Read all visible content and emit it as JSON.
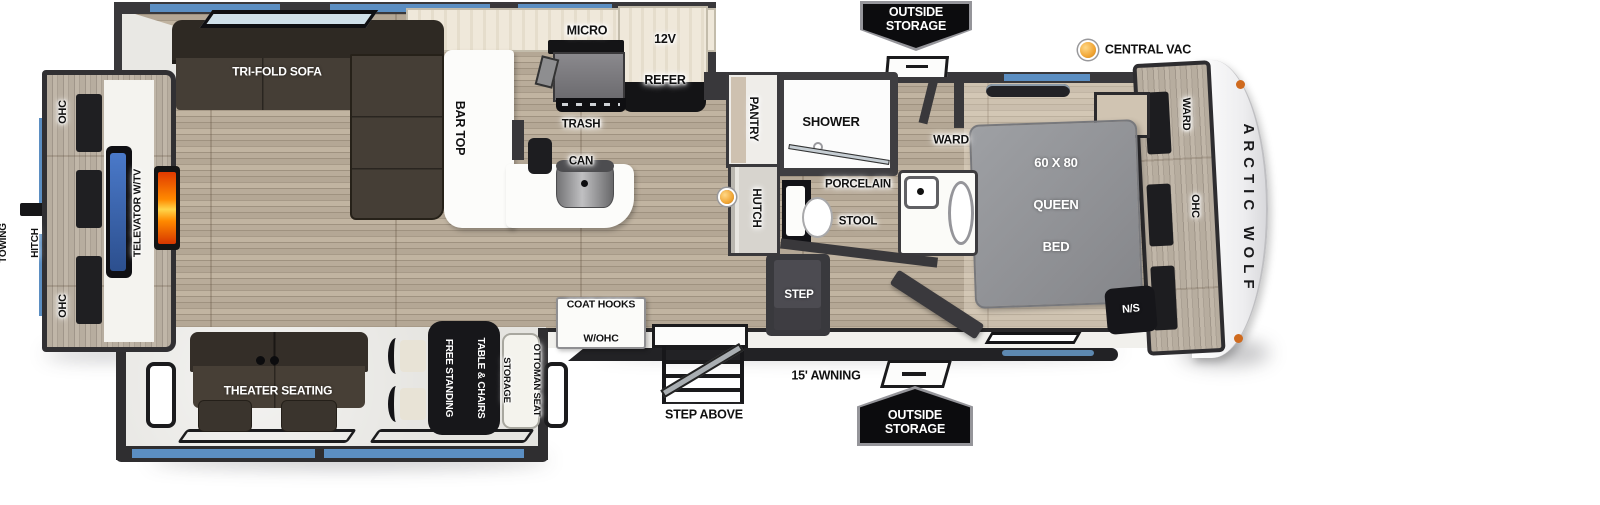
{
  "brand": "ARCTIC WOLF",
  "colors": {
    "accent_blue": "#5b8ec2",
    "wall_dark": "#39383b",
    "floor_wood": "#b2a593",
    "bed_gray": "#95969a",
    "banner_black": "#0c0c0e",
    "vac_orange": "#f0a433"
  },
  "rear": {
    "towing_hitch_l1": "TOWING",
    "towing_hitch_l2": "HITCH",
    "ohc_top": "OHC",
    "ohc_bottom": "OHC",
    "televator": "TELEVATOR W/TV"
  },
  "living": {
    "sofa": "TRI-FOLD SOFA",
    "theater": "THEATER SEATING"
  },
  "kitchen": {
    "micro": "MICRO",
    "refer_l1": "12V",
    "refer_l2": "REFER",
    "bar_top": "BAR TOP",
    "trash_l1": "TRASH",
    "trash_l2": "CAN",
    "pantry": "PANTRY",
    "hutch": "HUTCH"
  },
  "bath": {
    "shower": "SHOWER",
    "stool_l1": "PORCELAIN",
    "stool_l2": "STOOL",
    "ward": "WARD"
  },
  "bedroom": {
    "bed_l1": "60 X 80",
    "bed_l2": "QUEEN",
    "bed_l3": "BED",
    "nightstand": "N/S",
    "ward": "WARD",
    "ohc": "OHC"
  },
  "bottom_slide": {
    "table_l1": "FREE STANDING",
    "table_l2": "TABLE & CHAIRS",
    "ottoman_l1": "STORAGE",
    "ottoman_l2": "OTTOMAN SEAT",
    "coat_l1": "COAT HOOKS",
    "coat_l2": "W/OHC"
  },
  "exterior": {
    "storage_l1": "OUTSIDE",
    "storage_l2": "STORAGE",
    "central_vac": "CENTRAL VAC",
    "awning": "15' AWNING",
    "step_above": "STEP ABOVE",
    "step": "STEP"
  }
}
